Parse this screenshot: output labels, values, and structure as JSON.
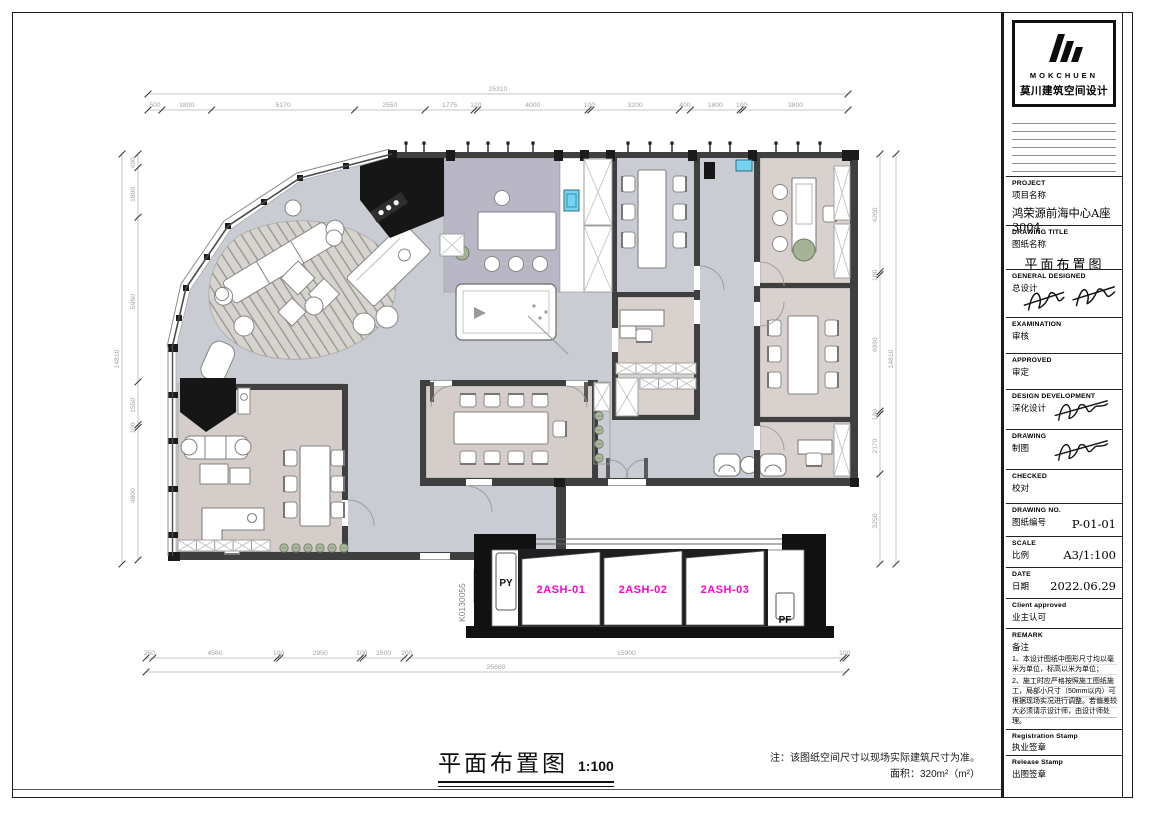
{
  "title_block": {
    "logo": {
      "brand": "MOKCHUEN",
      "brand_cn": "莫川建筑空间设计"
    },
    "fields": [
      {
        "en": "PROJECT",
        "cn": "项目名称",
        "value": "鸿荣源前海中心A座3004"
      },
      {
        "en": "DRAWING TITLE",
        "cn": "图纸名称",
        "value": "平面布置图"
      },
      {
        "en": "GENERAL  DESIGNED",
        "cn": "总设计",
        "value": ""
      },
      {
        "en": "EXAMINATION",
        "cn": "审核",
        "value": ""
      },
      {
        "en": "APPROVED",
        "cn": "审定",
        "value": ""
      },
      {
        "en": "DESIGN DEVELOPMENT",
        "cn": "深化设计",
        "value": ""
      },
      {
        "en": "DRAWING",
        "cn": "制图",
        "value": ""
      },
      {
        "en": "CHECKED",
        "cn": "校对",
        "value": ""
      },
      {
        "en": "DRAWING NO.",
        "cn": "图纸编号",
        "value": "P-01-01"
      },
      {
        "en": "SCALE",
        "cn": "比例",
        "value": "A3/1:100"
      },
      {
        "en": "DATE",
        "cn": "日期",
        "value": "2022.06.29"
      },
      {
        "en": "Client approved",
        "cn": "业主认可",
        "value": ""
      }
    ],
    "remark": {
      "en": "REMARK",
      "cn": "备注",
      "notes": [
        "1、本设计图纸中图形尺寸均以毫米为单位，标高以米为单位；",
        "2、施工时应严格按照施工图纸施工，局部小尺寸（50mm以内）可根据现场实况进行调整。若偏差较大必须请示设计师，由设计师处理。"
      ]
    },
    "stamps": [
      {
        "en": "Registration Stamp",
        "cn": "执业签章"
      },
      {
        "en": "Release Stamp",
        "cn": "出图签章"
      }
    ]
  },
  "plan": {
    "dims": {
      "top": {
        "total": "25310",
        "segments": [
          "500",
          "1800",
          "5170",
          "2550",
          "1775",
          "120",
          "4000",
          "100",
          "3200",
          "400",
          "1800",
          "100",
          "3800"
        ]
      },
      "bottom": {
        "total": "25660",
        "segments": [
          "250",
          "4560",
          "100",
          "2950",
          "100",
          "1500",
          "200",
          "15900",
          "100"
        ]
      },
      "left": {
        "total": "14810",
        "segments": [
          "490",
          "1800",
          "5960",
          "1550",
          "100",
          "4800"
        ]
      },
      "right": {
        "total": "14810",
        "segments": [
          "4260",
          "100",
          "4930",
          "100",
          "2170",
          "3250"
        ]
      }
    },
    "labels": {
      "panel1": "2ASH-01",
      "panel2": "2ASH-02",
      "panel3": "2ASH-03",
      "py": "PY",
      "pf": "PF",
      "code": "K0130055"
    },
    "colors": {
      "accent_magenta": "#ff00cd",
      "open_floor": "#caccd4",
      "room_floor": "#d8d1ce",
      "pantry_floor": "#b9b7c6",
      "wall": "#3f3f3f",
      "water_blue": "#74d4f0"
    }
  },
  "footer": {
    "title": "平面布置图",
    "scale": "1:100",
    "note": "注：该图纸空间尺寸以现场实际建筑尺寸为准。",
    "area": "面积：320m²（m²）"
  }
}
